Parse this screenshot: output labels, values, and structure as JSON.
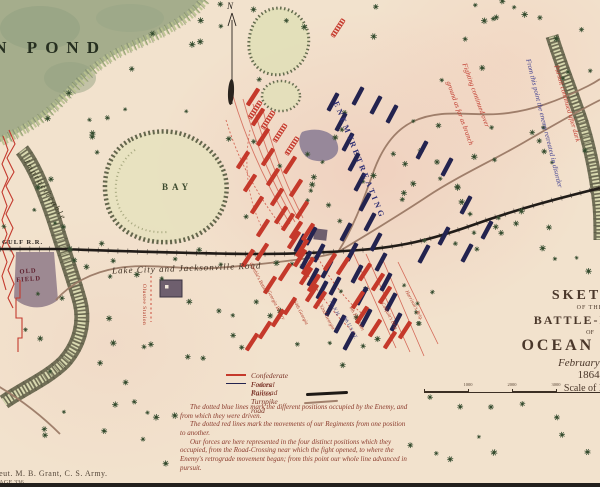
{
  "map": {
    "labels": {
      "pond": "AN POND",
      "bay": "BAY",
      "impracticable": "Impracticable",
      "old_field_1": "OLD",
      "old_field_2": "FIELD",
      "gulf_rr": "GULF R.R.",
      "road": "Lake City and Jacksonville Road",
      "enemy": "ENEMY",
      "retreating": "RETREATING",
      "fighting1": "Fighting continued over",
      "fighting2": "ground as far as branch",
      "retreated": "From this point the enemy retreated in disorder",
      "pursuit": "Pursuit continued after dark",
      "station": "Olustee Station",
      "north": "N"
    },
    "title": [
      "SKETCH",
      "OF THE",
      "BATTLE-FIELD",
      "OF",
      "OCEAN POND",
      "February 20th",
      "1864.",
      "Scale of Feet"
    ],
    "scale_labels": [
      "1000",
      "2000",
      "3000"
    ],
    "legend": {
      "confederate": "Confederate Forces",
      "federal": "Federal Forces",
      "railroad": "Railroad",
      "turnpike": "Turnpike road"
    },
    "notes": [
      "The dotted blue lines mark the different positions occupied by the Enemy, and from which they were driven.",
      "The dotted red lines mark the movements of our Regiments from one position to another.",
      "Our forces are here represented in the four distinct positions which they occupied, from the Road-Crossing near which the fight opened, to where the Enemy's retrograde movement began; from this point our whole line advanced in pursuit."
    ],
    "credit": "Lieut. M. B. Grant, C. S. Army.",
    "page": "PAGE 336",
    "colors": {
      "paper": "#f2e2cd",
      "pond": "#a5ad8c",
      "confederate": "#c5392b",
      "federal": "#23234f",
      "railroad": "#211c18",
      "road": "#9b7a66",
      "swamp": "#5a5a42",
      "note_ink": "#8a3a2c"
    },
    "forces": {
      "federal_bars": [
        [
          333,
          102
        ],
        [
          341,
          122
        ],
        [
          348,
          142
        ],
        [
          354,
          162
        ],
        [
          360,
          182
        ],
        [
          365,
          202
        ],
        [
          370,
          222
        ],
        [
          376,
          242
        ],
        [
          381,
          262
        ],
        [
          386,
          282
        ],
        [
          391,
          302
        ],
        [
          396,
          322
        ],
        [
          358,
          96
        ],
        [
          376,
          105
        ],
        [
          392,
          114
        ],
        [
          346,
          232
        ],
        [
          352,
          252
        ],
        [
          357,
          274
        ],
        [
          362,
          296
        ],
        [
          366,
          318
        ],
        [
          422,
          150
        ],
        [
          447,
          167
        ],
        [
          466,
          205
        ],
        [
          444,
          236
        ],
        [
          424,
          254
        ],
        [
          467,
          253
        ],
        [
          487,
          230
        ],
        [
          311,
          236
        ],
        [
          319,
          253
        ],
        [
          327,
          269
        ],
        [
          335,
          286
        ],
        [
          322,
          290
        ],
        [
          331,
          307
        ],
        [
          340,
          324
        ],
        [
          349,
          341
        ],
        [
          300,
          243
        ],
        [
          306,
          260
        ],
        [
          313,
          277
        ]
      ],
      "confederate_bars": [
        [
          253,
          97
        ],
        [
          258,
          117
        ],
        [
          263,
          137
        ],
        [
          268,
          157
        ],
        [
          273,
          177
        ],
        [
          277,
          197
        ],
        [
          281,
          215
        ],
        [
          243,
          160
        ],
        [
          250,
          183
        ],
        [
          257,
          205
        ],
        [
          263,
          228
        ],
        [
          290,
          165
        ],
        [
          296,
          188
        ],
        [
          302,
          210
        ],
        [
          308,
          232
        ],
        [
          288,
          222
        ],
        [
          294,
          240
        ],
        [
          300,
          258
        ],
        [
          306,
          276
        ],
        [
          312,
          293
        ],
        [
          296,
          230
        ],
        [
          302,
          248
        ],
        [
          308,
          266
        ],
        [
          314,
          283
        ],
        [
          320,
          300
        ],
        [
          248,
          258
        ],
        [
          262,
          252
        ],
        [
          270,
          285
        ],
        [
          285,
          272
        ],
        [
          330,
          262
        ],
        [
          343,
          266
        ],
        [
          358,
          300
        ],
        [
          362,
          315
        ],
        [
          375,
          328
        ],
        [
          390,
          340
        ],
        [
          405,
          330
        ],
        [
          385,
          295
        ],
        [
          290,
          306
        ],
        [
          278,
          318
        ],
        [
          265,
          330
        ],
        [
          252,
          342
        ],
        [
          365,
          272
        ],
        [
          378,
          282
        ]
      ],
      "confederate_camps": [
        [
          268,
          120
        ],
        [
          280,
          133
        ],
        [
          292,
          146
        ],
        [
          338,
          28
        ],
        [
          255,
          110
        ]
      ]
    },
    "unit_labels": [
      [
        252,
        262,
        "Gamble's Battery"
      ],
      [
        270,
        290,
        "Georgia Battery"
      ],
      [
        296,
        300,
        "64th Georgia"
      ],
      [
        322,
        304,
        "32nd Georgia"
      ],
      [
        352,
        306,
        "6th Fla Battn"
      ],
      [
        384,
        302,
        "Colquitt's Brig."
      ],
      [
        408,
        290,
        "Harrison's Brig."
      ]
    ],
    "federal_labels": [
      [
        332,
        300,
        "7th N.H."
      ],
      [
        346,
        316,
        "8th U.S.C.T."
      ]
    ]
  }
}
